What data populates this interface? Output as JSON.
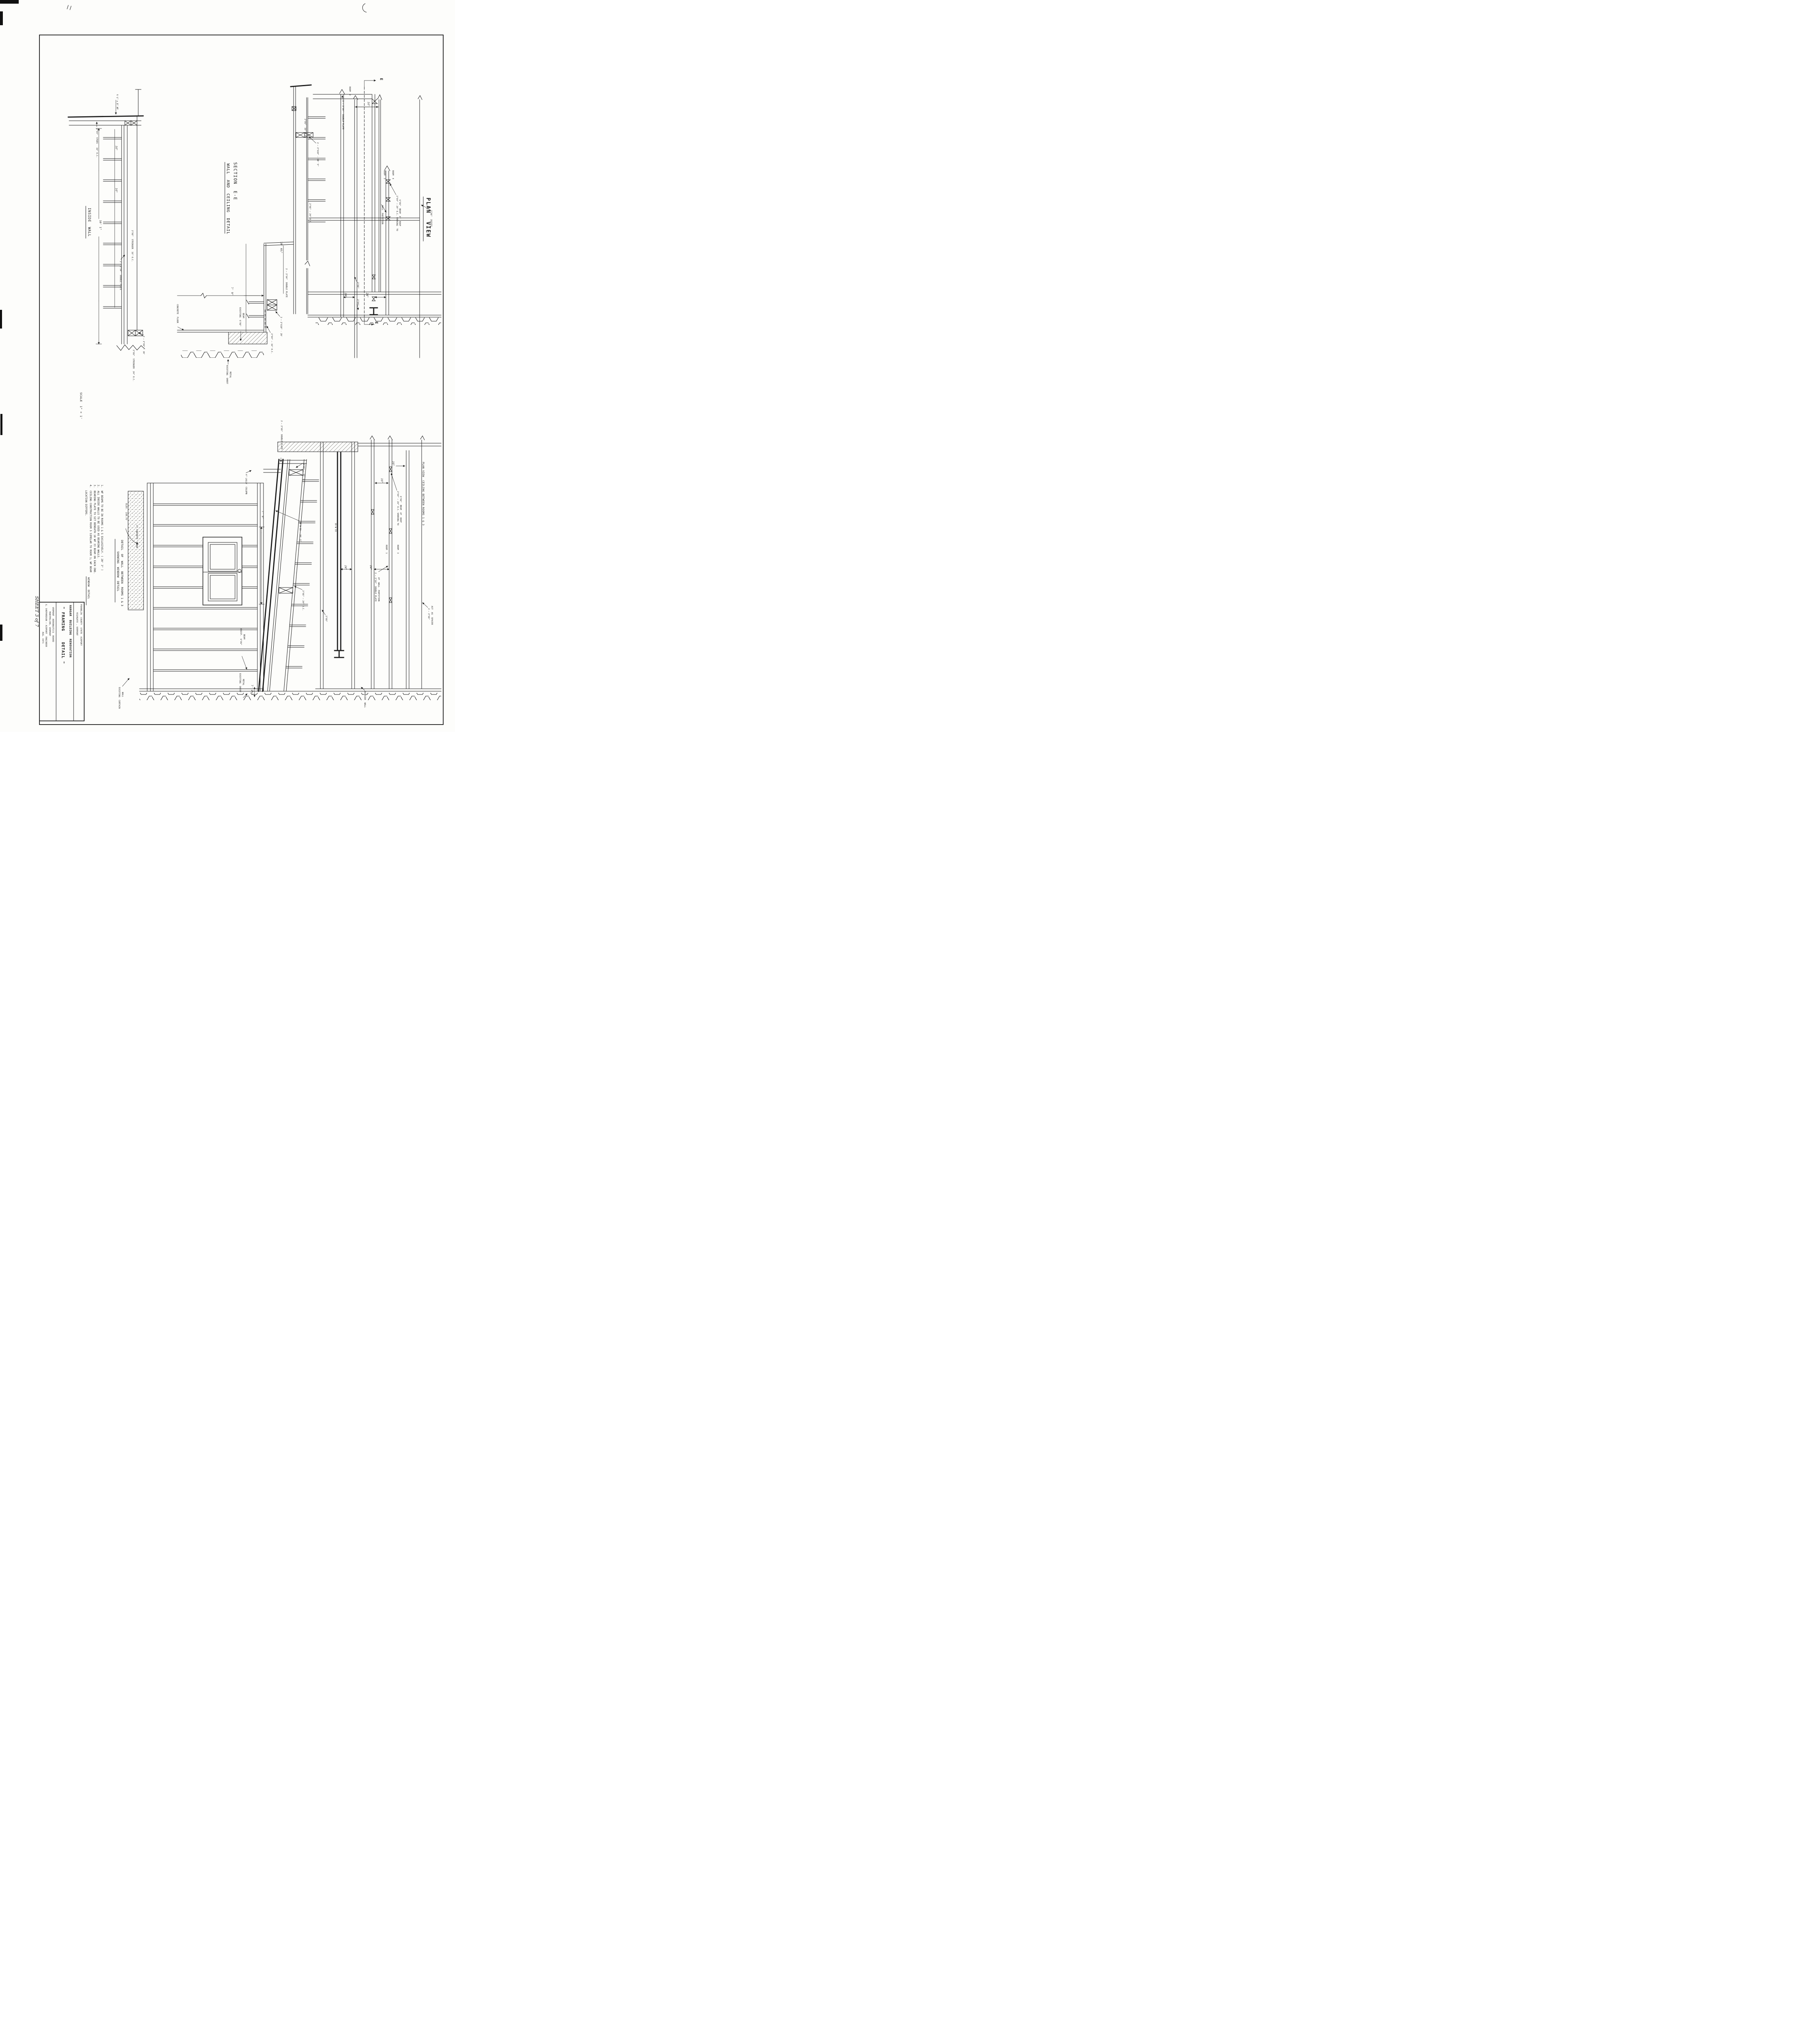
{
  "sheet": {
    "sheet_number": "SHEET 3 of 7",
    "scale_note": "SCALE  1\" = 1'",
    "window_detail_note": "WINDOW  DETAIL"
  },
  "title_block": {
    "client_line1": "FRANKLIN  COUNTY  STATE  AIRPORT",
    "client_line2": "HIGHGATE , VERMONT",
    "project_line1": "HANGAR  BUILDING  RENOVATION",
    "project_line2": "\" FRAMING    DETAIL \"",
    "agency_line1": "VERMONT  AERONAUTICS  BOARD",
    "agency_line2": "MONTPELIER, VERMONT",
    "engineer_line": "G. SHEPARDSON — AIRPORT  ENGINEER",
    "date_line": "AUG. 1971"
  },
  "notes": {
    "n1": "1.  WF BEAMS TO BE IN ROOMS 1 & 5 EXCLUSIVELY. ( 20' 3\" )",
    "n2": "2.  ALL INSIDE WALLS TO BE USED AS BEARING WALLS.",
    "n3": "3.  BEARING PLATE TO SIT BENEATH 10 WF 33 BEAM ON EACH END.",
    "n4": "4.  CEILING CONSTRUCTION ROOM 5 SIMILAR TO ROOM 1; WF BEAM",
    "n4_cont": "LOCATION DIFFERS."
  },
  "inside_wall": {
    "title": "INSIDE  WALL",
    "wf_beam": "6 ½\" x 8\" WF",
    "studs": "2\"X4\"  STUDS   16\" O.C.",
    "dim_16a": "16\"",
    "dim_16b": "16\"",
    "dim_height": "10' 1\"",
    "stringer16": "2\"X6\"  STRINGER  16\" O.C.",
    "double_plate": "2 — 2\"X4\"  DOUBLE PLATE",
    "blocking": "2 — 2\"X6\" - 10'",
    "stringer24": "2\"X6\"  STRINGER  24\" O.C."
  },
  "section_ee": {
    "title": "SECTION  E-E",
    "subtitle": "WALL  AND  CEILING  DETAIL",
    "joist16": "2\"X6\"  16\" O.C.",
    "blocking10": "2 — 2\"X10\" - 10' 5\"",
    "joist24": "2\"X6\" — 24\" O.C.",
    "dim_7_9": "7' 9\"",
    "dim_10_6": "10' 6½\"",
    "double_plate": "2 — 2\"X4\"  DOUBLE PLATE",
    "existing_beam_l1": "EXISTING  6\"X6\"",
    "existing_beam_l2": "BEAM",
    "blocking20": "2 — 2\"X10\" - 20'",
    "stud_2x4": "2\"X4\" — 16\" O.C.",
    "concrete_floor": "CONCRETE  FLOOR",
    "sheet_metal_l1": "EXISTING  SHEET",
    "sheet_metal_l2": "METAL"
  },
  "plan_view": {
    "title": "PLAN  VIEW",
    "room2": "ROOM  2",
    "room3": "ROOM  3",
    "room4": "ROOM  4",
    "double_plate": "2 — 2\"X4\"  DOUBLE PLATE",
    "dim16": "16\"",
    "shoring_l1": "2\"X4\" — 24\" O.C. SHORING  TO",
    "shoring_l2": "6\"X6\"  BEAM  AT  ROOF",
    "wall_partition": "WALL  PARTITION",
    "joists": "2\"X6\"  JOISTS",
    "dim24a": "24\"",
    "dim24b": "24\"",
    "lbl_2x6": "2\"X6\"",
    "lbl_2x4": "2\"X4\"",
    "marker_e_top": "E",
    "marker_e_bottom": "E"
  },
  "window_detail": {
    "title_l1": "DETAIL  OF  WALL  BETWEEN  ROOMS 1 & 3",
    "title_l2": "SHOWING  WINDOW  DETAIL",
    "double_plate": "2 — 2\"X6\"  DOUBLE PLATE",
    "joist16": "2\"X6\" — 16\" O.C.",
    "lally": "4\" LALLY  COLUMN",
    "elev": "ELEV.  230.75'",
    "concrete": "4\" CONCRETE  FLOOR",
    "dim_7_9": "7' 9\"",
    "beam": "10 W 33 — 20' 5\"",
    "joist24": "2\"X6\" — 24\" O.C.",
    "exist_beam_l1": "EXIST.  6\"X6\"",
    "exist_beam_l2": "BEAM",
    "sheet_metal_l1": "EXISTING  SHEET",
    "sheet_metal_l2": "METAL",
    "dim_7_2": "7' 2½\"",
    "curtain_l1": "EXISTING  CURTAIN",
    "curtain_l2": "WALL"
  },
  "plan_ceiling": {
    "title": "PLAN VIEW  CEILING BETWEEN ROOMS 1 & 3",
    "dim16a": "16\"",
    "dim16b": "16\"",
    "shoring_l1": "2\"X4\" — 24\" O.C. SHORING TO",
    "shoring_l2": "6\"X6\"  BEAM  AT  ROOF",
    "room1": "ROOM  1",
    "room3": "ROOM  3",
    "dim24a": "24\"",
    "dim24b": "24\"",
    "double_plate_l1": "2 — 2\"X4\"  DOUBLE PLATE",
    "double_plate_l2": "AT  WALL  PARTITION",
    "beam": "10 W 33",
    "spacer_l1": "2 — 2\"X6\"",
    "spacer_l2": "ACT  AS  SPACER",
    "lbl_2x6": "2\"X6\"",
    "outside_wall": "OUTSIDE  WALL"
  }
}
